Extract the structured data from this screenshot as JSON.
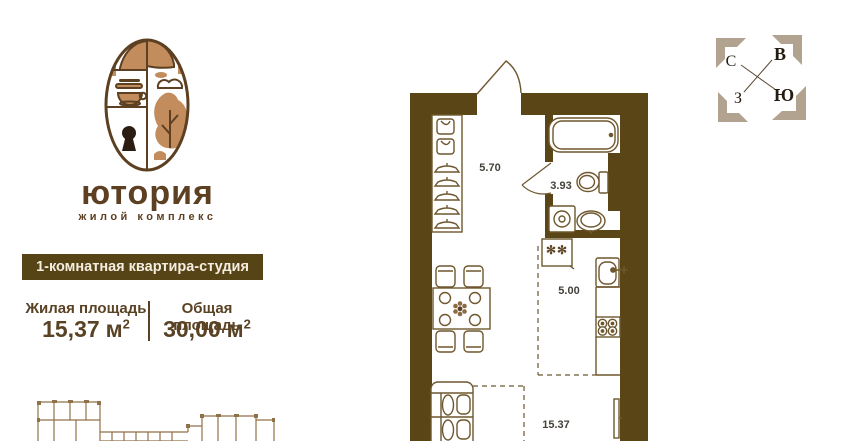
{
  "logo": {
    "brand": "ютория",
    "tagline": "жилой комплекс"
  },
  "banner": {
    "label": "1-комнатная квартира-студия"
  },
  "areas": {
    "living": {
      "label": "Жилая площадь",
      "value": "15,37",
      "unit": "м",
      "sup": "2"
    },
    "total": {
      "label": "Общая площадь",
      "value": "30,00",
      "unit": "м",
      "sup": "2"
    }
  },
  "compass": {
    "north": "С",
    "east": "В",
    "west": "З",
    "south": "Ю"
  },
  "floorplan": {
    "rooms": [
      {
        "id": "hallway",
        "area_label": "5.70"
      },
      {
        "id": "bathroom",
        "area_label": "3.93"
      },
      {
        "id": "kitchen",
        "area_label": "5.00"
      },
      {
        "id": "living-room",
        "area_label": "15.37"
      }
    ],
    "fridge_marking": "✻✻"
  },
  "colors": {
    "wall": "#5a4517",
    "banner_bg": "#564416",
    "brand_text": "#5d4021",
    "accent_tan": "#c28c5c",
    "furniture_line": "#6e572e",
    "compass_bracket": "#b2a390",
    "overview_line": "#8f7148"
  }
}
